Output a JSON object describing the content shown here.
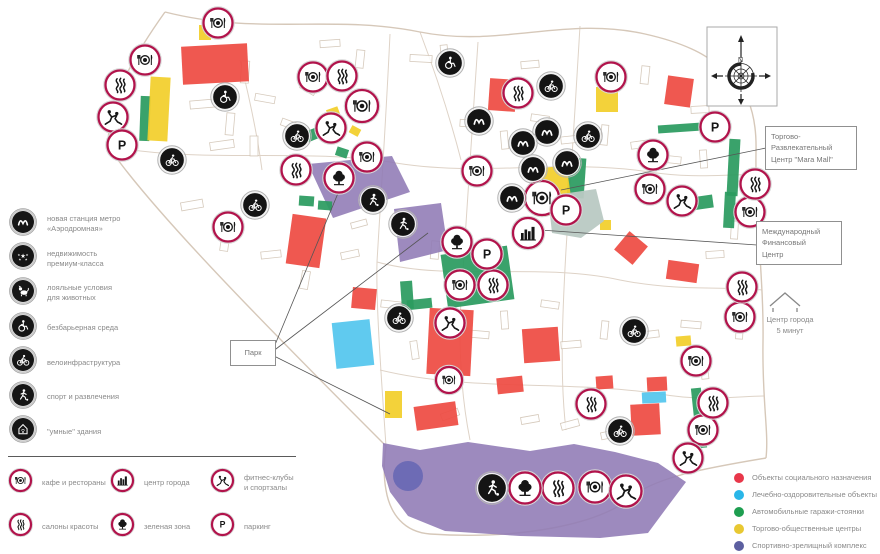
{
  "legend_features": {
    "items": [
      {
        "icon": "metro",
        "label": "новая станция метро\n«Аэродромная»"
      },
      {
        "icon": "stars",
        "label": "недвижимость\nпремиум-класса"
      },
      {
        "icon": "dog",
        "label": "лояльные условия\nдля животных"
      },
      {
        "icon": "wheel",
        "label": "безбарьерная среда"
      },
      {
        "icon": "bike",
        "label": "велоинфраструктура"
      },
      {
        "icon": "runner",
        "label": "спорт и развлечения"
      },
      {
        "icon": "smarthome",
        "label": "\"умные\" здания"
      }
    ]
  },
  "legend_places": {
    "items": [
      {
        "icon": "cafe",
        "label": "кафе и рестораны"
      },
      {
        "icon": "city",
        "label": "центр города"
      },
      {
        "icon": "fitness",
        "label": "фитнес-клубы\nи спортзалы"
      },
      {
        "icon": "salon",
        "label": "салоны красоты"
      },
      {
        "icon": "tree",
        "label": "зеленая зона"
      },
      {
        "icon": "parking",
        "label": "паркинг"
      }
    ]
  },
  "legend_zones": {
    "items": [
      {
        "color": "#e8374a",
        "label": "Объекты социального назначения"
      },
      {
        "color": "#29b6e8",
        "label": "Лечебно-оздоровительные объекты"
      },
      {
        "color": "#1e9e50",
        "label": "Автомобильные гаражи-стоянки"
      },
      {
        "color": "#e8c832",
        "label": "Торгово-общественные центры"
      },
      {
        "color": "#5c5fa0",
        "label": "Спортивно-зрелищный комплекс"
      }
    ]
  },
  "map": {
    "compass_n": "N",
    "labels": {
      "park": "Парк",
      "mara_mall": "Торгово-\nРазвлекательный\nЦентр \"Mara Mall\"",
      "mfc": "Международный\nФинансовый\nЦентр",
      "city_center_note": "Центр города\n5 минут"
    },
    "leader_lines": [
      [
        272,
        352,
        341,
        186
      ],
      [
        272,
        352,
        428,
        233
      ],
      [
        274,
        356,
        390,
        414
      ],
      [
        766,
        148,
        561,
        190
      ],
      [
        757,
        245,
        540,
        230
      ]
    ],
    "palette": {
      "social": "#ee4b43",
      "medical": "#54c6ee",
      "garage": "#2b9b60",
      "retail": "#f2cf2b",
      "park": "#8f7ab5",
      "pond": "#6a69b4",
      "finance_center": "#b9c9c3",
      "sport": "#5b4a9b",
      "marker_ring": "#b1134b",
      "marker_black": "#141414"
    },
    "markers": [
      [
        "cafe",
        218,
        23
      ],
      [
        "cafe",
        145,
        60
      ],
      [
        "cafe",
        313,
        77
      ],
      [
        "cafe",
        611,
        77
      ],
      [
        "cafe",
        362,
        106,
        32
      ],
      [
        "cafe",
        367,
        157
      ],
      [
        "cafe",
        477,
        171
      ],
      [
        "cafe",
        650,
        189
      ],
      [
        "cafe",
        542,
        198,
        34
      ],
      [
        "cafe",
        750,
        212
      ],
      [
        "cafe",
        228,
        227
      ],
      [
        "cafe",
        460,
        285
      ],
      [
        "cafe",
        740,
        317
      ],
      [
        "cafe",
        696,
        361
      ],
      [
        "cafe",
        449,
        380,
        26
      ],
      [
        "cafe",
        703,
        430
      ],
      [
        "cafe",
        595,
        487,
        31
      ],
      [
        "salon",
        120,
        85
      ],
      [
        "salon",
        342,
        76
      ],
      [
        "salon",
        518,
        93
      ],
      [
        "salon",
        296,
        170
      ],
      [
        "salon",
        755,
        184
      ],
      [
        "salon",
        493,
        285
      ],
      [
        "salon",
        742,
        287
      ],
      [
        "salon",
        591,
        404
      ],
      [
        "salon",
        713,
        403
      ],
      [
        "salon",
        558,
        488,
        31
      ],
      [
        "fitness",
        113,
        117
      ],
      [
        "fitness",
        331,
        128
      ],
      [
        "fitness",
        682,
        201
      ],
      [
        "fitness",
        450,
        323
      ],
      [
        "fitness",
        688,
        458
      ],
      [
        "fitness",
        626,
        491,
        31
      ],
      [
        "parking",
        122,
        145
      ],
      [
        "parking",
        715,
        127
      ],
      [
        "parking",
        566,
        210
      ],
      [
        "parking",
        487,
        254
      ],
      [
        "tree",
        653,
        155
      ],
      [
        "tree",
        339,
        178
      ],
      [
        "tree",
        457,
        242
      ],
      [
        "tree",
        525,
        488,
        31
      ],
      [
        "city",
        528,
        233,
        30
      ],
      [
        "metro_b",
        479,
        121
      ],
      [
        "metro_b",
        547,
        132
      ],
      [
        "metro_b",
        523,
        143
      ],
      [
        "metro_b",
        533,
        169
      ],
      [
        "metro_b",
        567,
        163
      ],
      [
        "metro_b",
        512,
        198
      ],
      [
        "bike_b",
        297,
        136
      ],
      [
        "bike_b",
        172,
        160
      ],
      [
        "bike_b",
        255,
        205
      ],
      [
        "bike_b",
        551,
        86
      ],
      [
        "bike_b",
        588,
        136
      ],
      [
        "bike_b",
        399,
        318
      ],
      [
        "bike_b",
        634,
        331
      ],
      [
        "bike_b",
        620,
        431
      ],
      [
        "wheel_b",
        225,
        97
      ],
      [
        "wheel_b",
        450,
        63
      ],
      [
        "runner_b",
        373,
        200
      ],
      [
        "runner_b",
        403,
        224
      ],
      [
        "runner_b",
        492,
        488,
        29
      ]
    ],
    "buildings": [
      {
        "t": "park",
        "p": [
          [
            308,
            164
          ],
          [
            392,
            156
          ],
          [
            410,
            192
          ],
          [
            333,
            218
          ]
        ]
      },
      {
        "t": "park",
        "p": [
          [
            394,
            209
          ],
          [
            441,
            203
          ],
          [
            448,
            250
          ],
          [
            400,
            262
          ]
        ]
      },
      {
        "t": "park",
        "p": [
          [
            383,
            443
          ],
          [
            420,
            450
          ],
          [
            468,
            442
          ],
          [
            530,
            451
          ],
          [
            574,
            444
          ],
          [
            615,
            452
          ],
          [
            658,
            463
          ],
          [
            686,
            482
          ],
          [
            668,
            506
          ],
          [
            648,
            533
          ],
          [
            600,
            538
          ],
          [
            520,
            536
          ],
          [
            445,
            531
          ],
          [
            408,
            516
          ],
          [
            390,
            492
          ],
          [
            382,
            466
          ]
        ]
      },
      {
        "t": "pond",
        "c": [
          408,
          476,
          15
        ]
      },
      {
        "t": "garage",
        "r": [
          140,
          96,
          10,
          45,
          2
        ]
      },
      {
        "t": "garage",
        "r": [
          305,
          126,
          31,
          11,
          -22
        ]
      },
      {
        "t": "garage",
        "r": [
          336,
          148,
          12,
          9,
          18
        ]
      },
      {
        "t": "garage",
        "r": [
          299,
          196,
          15,
          10,
          4
        ]
      },
      {
        "t": "garage",
        "r": [
          318,
          201,
          14,
          9,
          4
        ]
      },
      {
        "t": "garage",
        "r": [
          401,
          281,
          12,
          28,
          -4
        ]
      },
      {
        "t": "garage",
        "r": [
          407,
          299,
          25,
          10,
          -6
        ]
      },
      {
        "t": "garage",
        "r": [
          444,
          250,
          67,
          54,
          -8
        ]
      },
      {
        "t": "garage",
        "r": [
          568,
          158,
          17,
          40,
          4
        ]
      },
      {
        "t": "garage",
        "r": [
          691,
          196,
          22,
          13,
          -8
        ]
      },
      {
        "t": "garage",
        "r": [
          658,
          124,
          44,
          8,
          -4
        ]
      },
      {
        "t": "garage",
        "r": [
          728,
          139,
          11,
          57,
          3
        ]
      },
      {
        "t": "garage",
        "r": [
          724,
          192,
          11,
          36,
          3
        ]
      },
      {
        "t": "garage",
        "r": [
          694,
          388,
          10,
          60,
          -6
        ]
      },
      {
        "t": "retail",
        "r": [
          149,
          77,
          20,
          64,
          3
        ]
      },
      {
        "t": "retail",
        "r": [
          199,
          25,
          12,
          15,
          0
        ]
      },
      {
        "t": "retail",
        "r": [
          596,
          87,
          22,
          25,
          0
        ]
      },
      {
        "t": "retail",
        "r": [
          536,
          167,
          34,
          48,
          -8
        ]
      },
      {
        "t": "retail",
        "r": [
          385,
          391,
          17,
          27,
          0
        ]
      },
      {
        "t": "retail",
        "r": [
          327,
          108,
          12,
          8,
          -20
        ]
      },
      {
        "t": "retail",
        "r": [
          350,
          127,
          10,
          8,
          28
        ]
      },
      {
        "t": "retail",
        "r": [
          600,
          220,
          11,
          10,
          0
        ]
      },
      {
        "t": "retail",
        "r": [
          676,
          336,
          15,
          10,
          -5
        ]
      },
      {
        "t": "medical",
        "r": [
          334,
          321,
          38,
          46,
          -6
        ]
      },
      {
        "t": "medical",
        "r": [
          642,
          392,
          24,
          11,
          -3
        ]
      },
      {
        "t": "social",
        "r": [
          182,
          45,
          66,
          38,
          -3
        ]
      },
      {
        "t": "social",
        "r": [
          289,
          216,
          34,
          50,
          8
        ]
      },
      {
        "t": "social",
        "r": [
          352,
          288,
          24,
          21,
          5
        ]
      },
      {
        "t": "social",
        "r": [
          489,
          79,
          27,
          32,
          4
        ]
      },
      {
        "t": "social",
        "r": [
          428,
          309,
          44,
          66,
          3
        ]
      },
      {
        "t": "social",
        "r": [
          523,
          328,
          36,
          34,
          -4
        ]
      },
      {
        "t": "social",
        "r": [
          415,
          404,
          42,
          24,
          -8
        ]
      },
      {
        "t": "social",
        "r": [
          497,
          377,
          26,
          16,
          -6
        ]
      },
      {
        "t": "social",
        "r": [
          596,
          376,
          17,
          13,
          -4
        ]
      },
      {
        "t": "social",
        "r": [
          631,
          404,
          29,
          31,
          -3
        ]
      },
      {
        "t": "social",
        "r": [
          647,
          377,
          20,
          14,
          -3
        ]
      },
      {
        "t": "social",
        "r": [
          619,
          236,
          24,
          24,
          40
        ]
      },
      {
        "t": "social",
        "r": [
          667,
          262,
          31,
          19,
          8
        ]
      },
      {
        "t": "social",
        "r": [
          666,
          77,
          26,
          29,
          8
        ]
      },
      {
        "t": "finance_center",
        "p": [
          [
            548,
            196
          ],
          [
            596,
            189
          ],
          [
            604,
            221
          ],
          [
            581,
            238
          ],
          [
            552,
            233
          ]
        ]
      },
      {
        "t": "sport",
        "r": [
          545,
          206,
          11,
          8,
          20
        ]
      },
      {
        "t": "sport",
        "r": [
          558,
          213,
          8,
          6,
          -10
        ]
      }
    ]
  }
}
